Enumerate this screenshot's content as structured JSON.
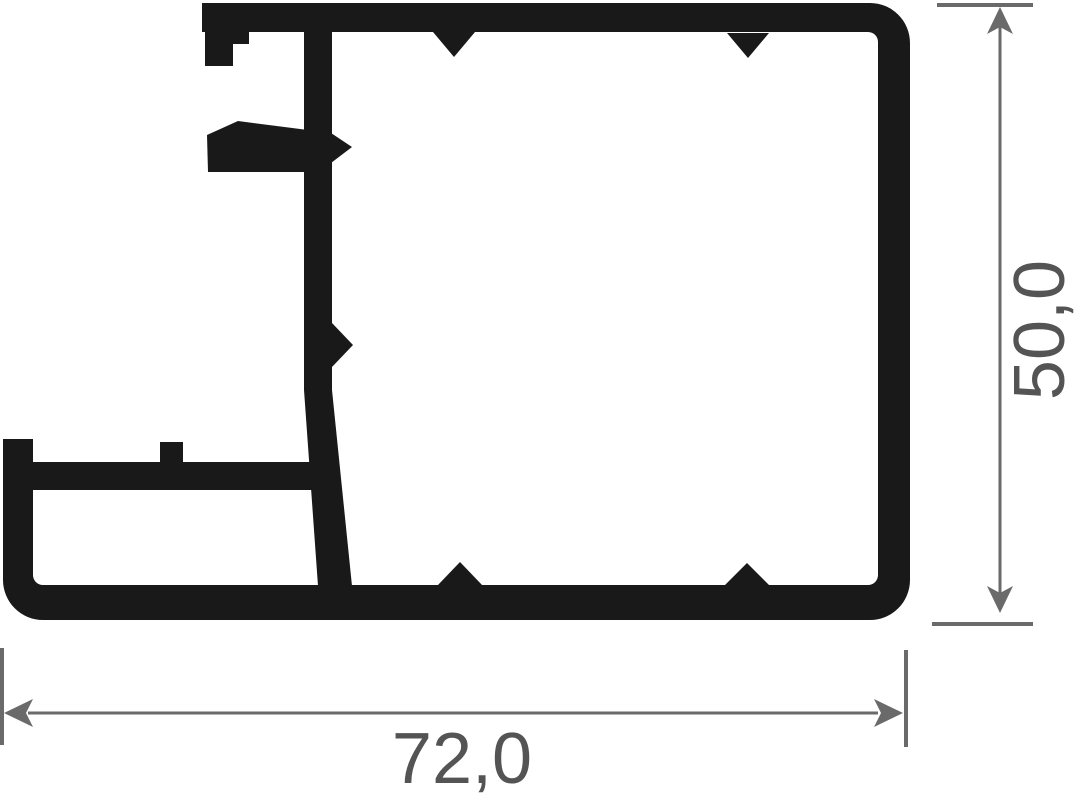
{
  "drawing": {
    "width_dimension": {
      "label": "72,0"
    },
    "height_dimension": {
      "label": "50,0"
    }
  },
  "colors": {
    "background": "#ffffff",
    "profile": "#191919",
    "dimension_lines": "#6a6a6a",
    "dimension_text": "#545454"
  }
}
